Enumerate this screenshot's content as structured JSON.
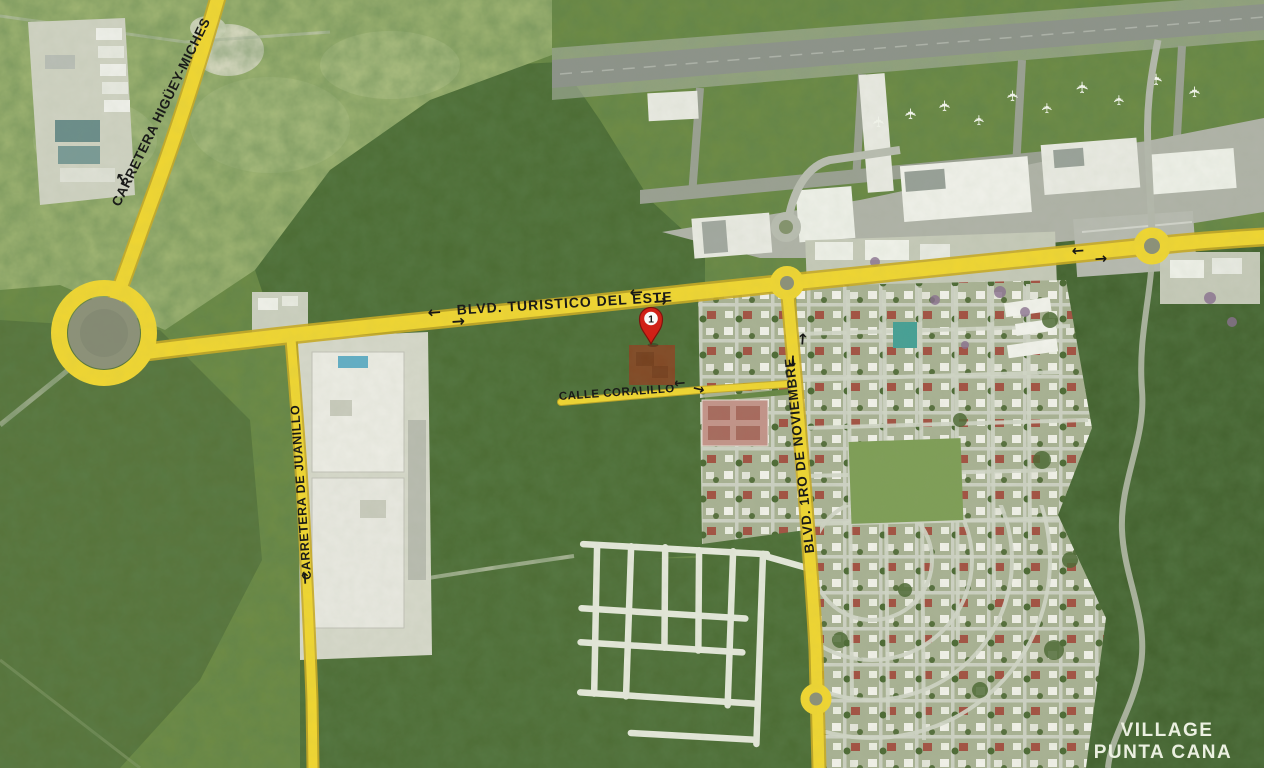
{
  "map": {
    "road_labels": {
      "carretera_higuey_miches": "CARRETERA HIGÜEY-MICHES",
      "blvd_turistico_del_este": "BLVD. TURISTICO DEL ESTE",
      "calle_coralillo": "CALLE CORALILLO",
      "carretera_de_juanillo": "CARRETERA DE JUANILLO",
      "blvd_1ro_de_noviembre": "BLVD. 1RO DE NOVIEMBRE"
    },
    "place_labels": {
      "village_line1": "VILLAGE",
      "village_line2": "PUNTA CANA"
    },
    "marker": {
      "label": "1"
    },
    "icons": {
      "arrow_left": "←",
      "arrow_right": "→",
      "arrow_up": "↑",
      "arrow_down": "↓",
      "airplane": "✈"
    },
    "colors": {
      "road_highlight": "#F0D632",
      "marker": "#D41B12",
      "parcel": "#8A4423",
      "road_label": "#151515",
      "place_label": "#F0F4E6"
    }
  }
}
